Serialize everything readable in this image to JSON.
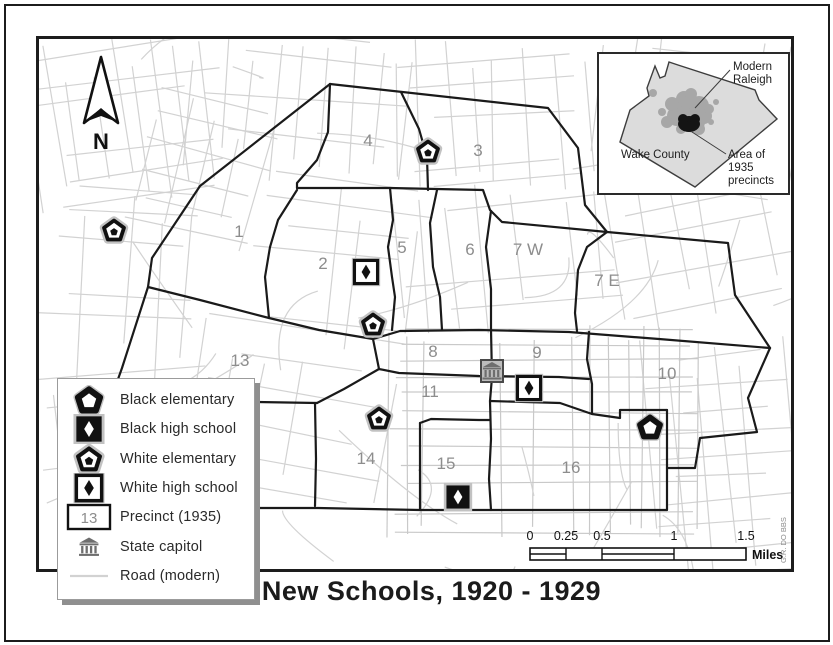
{
  "title": "New Schools, 1920 - 1929",
  "credit": "G.R. DO BBS",
  "north_label": "N",
  "colors": {
    "road": "#d2d2d2",
    "road_dense": "#c9c9c9",
    "boundary": "#1a1a1a",
    "precinct_label": "#8d8d8d",
    "symbol_halo": "#c2c2c2",
    "capitol_gray": "#6e6e6e",
    "inset_county_fill": "#dcdcdc",
    "inset_raleigh_fill": "#a7a7a7",
    "inset_precinct_fill": "#141414"
  },
  "legend": {
    "items": [
      {
        "icon": "black-elementary-icon",
        "label": "Black elementary"
      },
      {
        "icon": "black-high-school-icon",
        "label": "Black high school"
      },
      {
        "icon": "white-elementary-icon",
        "label": "White elementary"
      },
      {
        "icon": "white-high-school-icon",
        "label": "White high school"
      },
      {
        "icon": "precinct-box-icon",
        "label": "Precinct (1935)"
      },
      {
        "icon": "state-capitol-icon",
        "label": "State capitol"
      },
      {
        "icon": "road-line-icon",
        "label": "Road (modern)"
      }
    ],
    "precinct_sample": "13"
  },
  "inset": {
    "modern_line1": "Modern",
    "modern_line2": "Raleigh",
    "wake_county": "Wake County",
    "area_line1": "Area of",
    "area_line2": "1935",
    "area_line3": "precincts"
  },
  "scalebar": {
    "ticks": [
      "0",
      "0.25",
      "0.5",
      "1",
      "1.5"
    ],
    "unit": "Miles"
  },
  "map": {
    "precincts": [
      {
        "label": "1",
        "x": 200,
        "y": 192
      },
      {
        "label": "2",
        "x": 284,
        "y": 224
      },
      {
        "label": "3",
        "x": 439,
        "y": 111
      },
      {
        "label": "4",
        "x": 329,
        "y": 101
      },
      {
        "label": "5",
        "x": 363,
        "y": 208
      },
      {
        "label": "6",
        "x": 431,
        "y": 210
      },
      {
        "label": "7 W",
        "x": 489,
        "y": 210
      },
      {
        "label": "7 E",
        "x": 568,
        "y": 241
      },
      {
        "label": "8",
        "x": 394,
        "y": 312
      },
      {
        "label": "9",
        "x": 498,
        "y": 313
      },
      {
        "label": "10",
        "x": 628,
        "y": 334
      },
      {
        "label": "11",
        "x": 391,
        "y": 352
      },
      {
        "label": "13",
        "x": 201,
        "y": 321
      },
      {
        "label": "14",
        "x": 327,
        "y": 419
      },
      {
        "label": "15",
        "x": 407,
        "y": 424
      },
      {
        "label": "16",
        "x": 532,
        "y": 428
      }
    ],
    "schools": [
      {
        "type": "white-elementary",
        "x": 75,
        "y": 192
      },
      {
        "type": "white-elementary",
        "x": 389,
        "y": 113
      },
      {
        "type": "white-elementary",
        "x": 334,
        "y": 286
      },
      {
        "type": "white-elementary",
        "x": 340,
        "y": 380
      },
      {
        "type": "black-elementary",
        "x": 611,
        "y": 389
      },
      {
        "type": "white-high",
        "x": 327,
        "y": 233
      },
      {
        "type": "white-high",
        "x": 490,
        "y": 349
      },
      {
        "type": "black-high",
        "x": 419,
        "y": 458
      }
    ],
    "capitol": {
      "x": 453,
      "y": 332
    }
  }
}
